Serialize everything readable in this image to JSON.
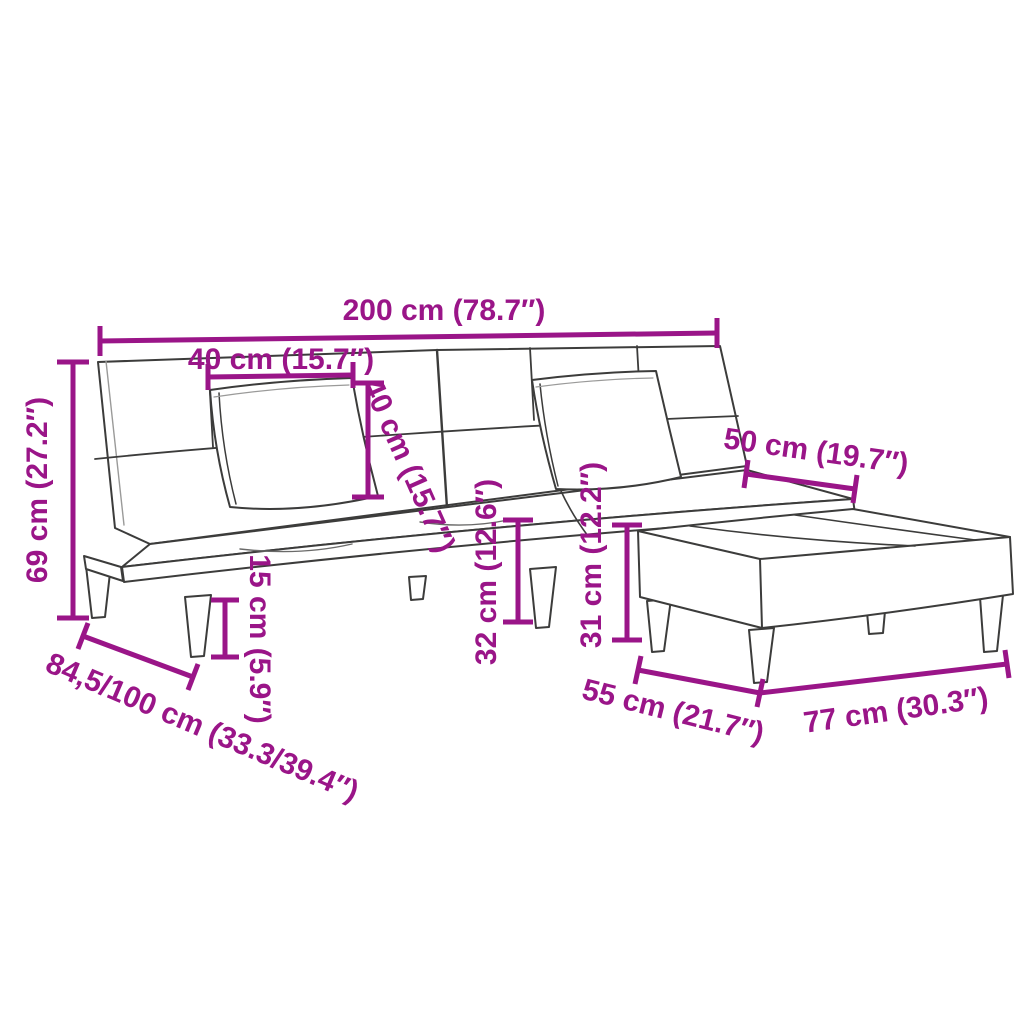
{
  "diagram": {
    "type": "furniture-dimension-diagram",
    "subject": "sofa bed with two pillows and footstool",
    "accent_color": "#9A1588",
    "outline_color": "#3C3C3B",
    "labels": {
      "total_width": "200 cm (78.7″)",
      "pillow_width": "40 cm (15.7″)",
      "pillow_height": "40 cm (15.7″)",
      "back_height": "69 cm (27.2″)",
      "seat_depth": "50 cm (19.7″)",
      "leg_height": "15 cm (5.9″)",
      "seat_height": "32 cm (12.6″)",
      "ottoman_height": "31 cm (12.2″)",
      "sofa_depth": "84,5/100 cm (33.3/39.4″)",
      "ottoman_depth": "55 cm (21.7″)",
      "ottoman_width": "77 cm (30.3″)"
    }
  }
}
